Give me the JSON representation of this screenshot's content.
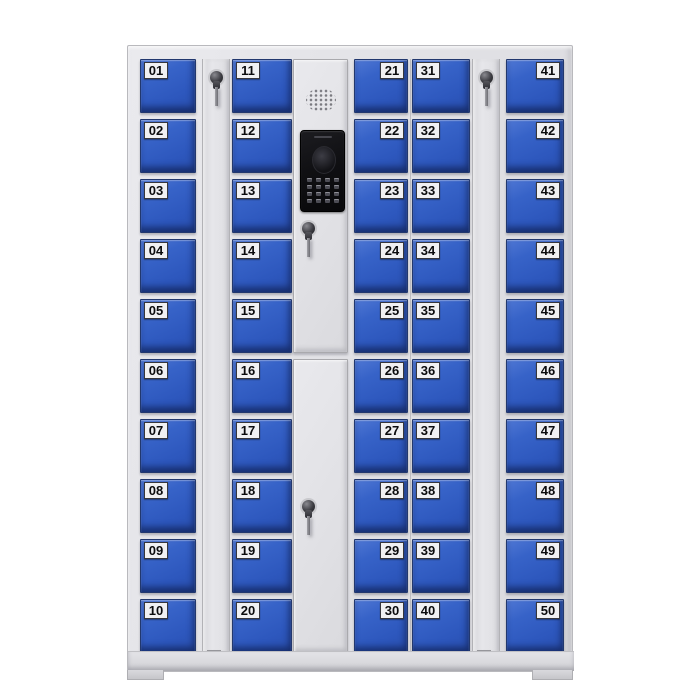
{
  "scene": {
    "background_color": "#ffffff",
    "subject": "smart-electronic-locker-cabinet"
  },
  "cabinet": {
    "body_color": "#e2e2e6",
    "door_color": "#2d57bd",
    "door_label_bg": "#f0f0f2",
    "door_label_text_color": "#0b0b0d",
    "door_count": 50,
    "columns": [
      {
        "name": "door-column-1",
        "label_side": "left",
        "doors": [
          "01",
          "02",
          "03",
          "04",
          "05",
          "06",
          "07",
          "08",
          "09",
          "10"
        ]
      },
      {
        "name": "door-column-2",
        "label_side": "left",
        "doors": [
          "11",
          "12",
          "13",
          "14",
          "15",
          "16",
          "17",
          "18",
          "19",
          "20"
        ]
      },
      {
        "name": "door-column-3",
        "label_side": "right",
        "doors": [
          "21",
          "22",
          "23",
          "24",
          "25",
          "26",
          "27",
          "28",
          "29",
          "30"
        ]
      },
      {
        "name": "door-column-4",
        "label_side": "left",
        "doors": [
          "31",
          "32",
          "33",
          "34",
          "35",
          "36",
          "37",
          "38",
          "39",
          "40"
        ]
      },
      {
        "name": "door-column-5",
        "label_side": "right",
        "doors": [
          "41",
          "42",
          "43",
          "44",
          "45",
          "46",
          "47",
          "48",
          "49",
          "50"
        ]
      }
    ],
    "lock_strips": [
      {
        "name": "side-lock-strip-left",
        "lock": "key-lock-with-key-inserted"
      },
      {
        "name": "side-lock-strip-right",
        "lock": "key-lock-with-key-inserted"
      }
    ],
    "control_panel": {
      "speaker": "speaker-grille",
      "display_unit": "camera-and-keypad-unit",
      "keypad": {
        "rows": 4,
        "cols": 4
      },
      "upper_lock": "key-lock-with-key-inserted",
      "lower_lock": "key-lock-with-key-inserted"
    }
  }
}
